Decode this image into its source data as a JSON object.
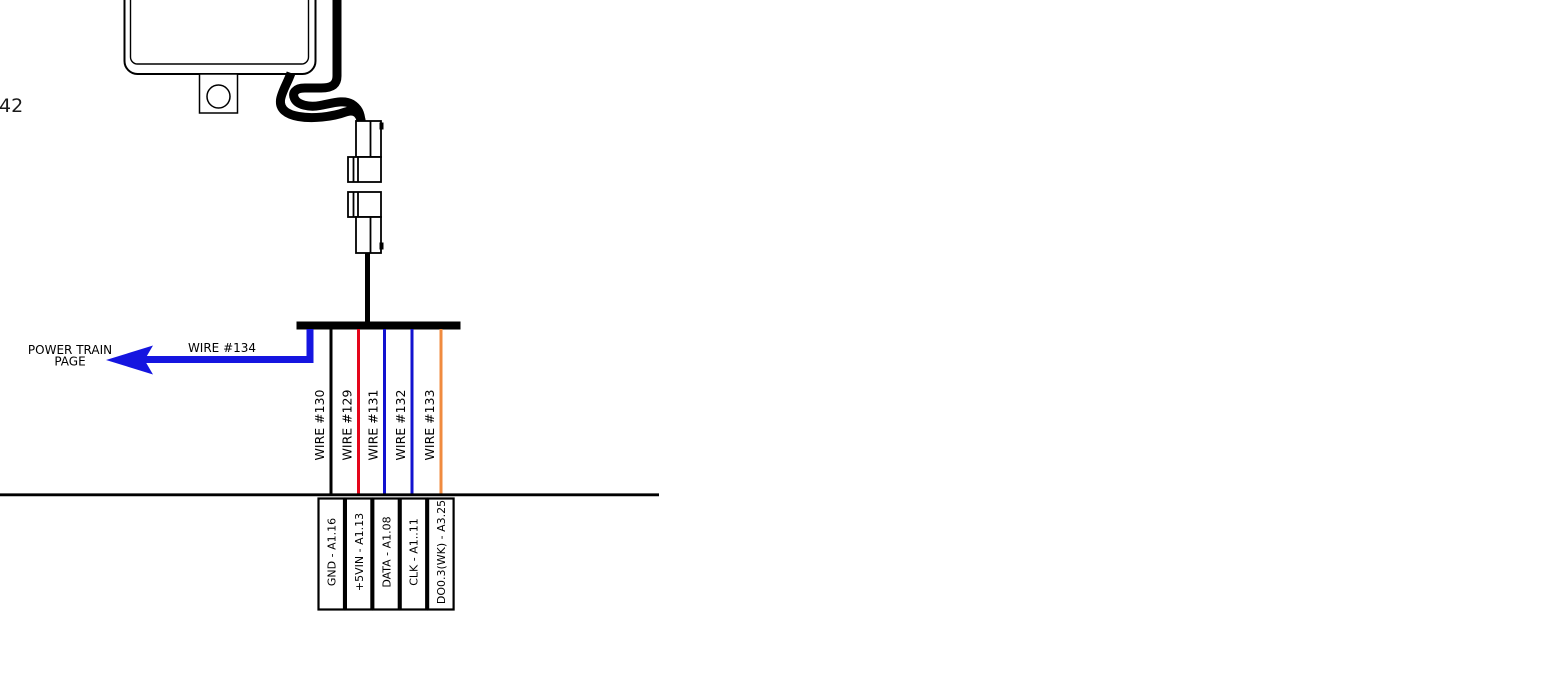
{
  "diagram": {
    "page_ref_number": "42",
    "off_page_reference": {
      "target_line1": "POWER TRAIN",
      "target_line2": "PAGE",
      "wire_label": "WIRE #134"
    },
    "colors": {
      "line_black": "#000000",
      "arrow_blue": "#1515e0",
      "wire_red": "#e4051a",
      "wire_blue": "#1212cf",
      "wire_orange": "#f08b3f"
    },
    "bus_wires": [
      {
        "label": "WIRE #130",
        "color": "#000000"
      },
      {
        "label": "WIRE #129",
        "color": "#e4051a"
      },
      {
        "label": "WIRE #131",
        "color": "#1212cf"
      },
      {
        "label": "WIRE #132",
        "color": "#1212cf"
      },
      {
        "label": "WIRE #133",
        "color": "#f08b3f"
      }
    ],
    "connector_pins": [
      {
        "label": "GND - A1.16"
      },
      {
        "label": "+5VIN - A1.13"
      },
      {
        "label": "DATA - A1.08"
      },
      {
        "label": "CLK - A1..11"
      },
      {
        "label": "DO0.3(WK) - A3.25"
      }
    ]
  }
}
